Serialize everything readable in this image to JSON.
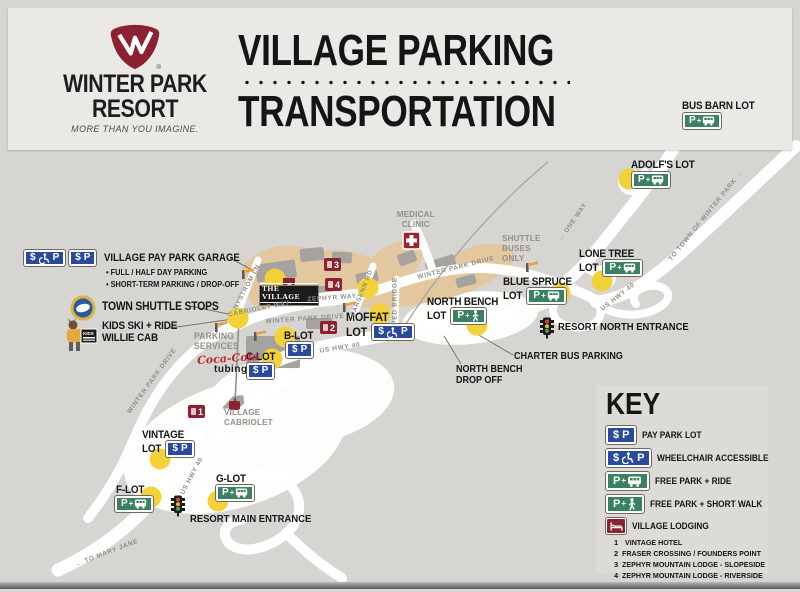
{
  "header": {
    "brand_top": "WINTER PARK",
    "brand_bottom": "RESORT",
    "reg": "®",
    "tagline": "MORE THAN YOU IMAGINE.",
    "title1": "VILLAGE PARKING",
    "title2": "TRANSPORTATION"
  },
  "glyphs": {
    "dollar": "$",
    "p": "P",
    "plus": "+",
    "bullet": "•"
  },
  "legend": {
    "garage_title": "VILLAGE PAY PARK GARAGE",
    "garage_b1": "FULL / HALF DAY PARKING",
    "garage_b2": "SHORT-TERM PARKING / DROP-OFF",
    "shuttle": "TOWN SHUTTLE STOPS",
    "kids1": "KIDS SKI + RIDE",
    "kids2": "WILLIE CAB"
  },
  "lots": {
    "bus_barn": "BUS BARN LOT",
    "adolfs": "ADOLF'S LOT",
    "lone_tree1": "LONE TREE",
    "blue_spruce1": "BLUE SPRUCE",
    "north_bench1": "NORTH BENCH",
    "moffat1": "MOFFAT",
    "lot_word": "LOT",
    "b": "B-LOT",
    "c": "C-LOT",
    "vintage1": "VINTAGE",
    "f": "F-LOT",
    "g": "G-LOT"
  },
  "pois": {
    "medical1": "MEDICAL",
    "medical2": "CLINIC",
    "sb1": "SHUTTLE",
    "sb2": "BUSES",
    "sb3": "ONLY",
    "resort_north": "RESORT NORTH ENTRANCE",
    "resort_main": "RESORT MAIN ENTRANCE",
    "charter": "CHARTER BUS PARKING",
    "drop1": "NORTH BENCH",
    "drop2": "DROP OFF",
    "parking1": "PARKING",
    "parking2": "SERVICES",
    "cab1": "VILLAGE",
    "cab2": "CABRIOLET",
    "village_banner": "THE VILLAGE",
    "village_sub": "AT WINTER PARK",
    "coke": "Coca-Cola",
    "tubing": "tubing"
  },
  "roads": {
    "nystrom": "NYSTROM LN",
    "cabriolet_way": "CABRIOLET WAY",
    "zephyr": "ZEPHYR WAY",
    "parsenn": "PARSENN RD",
    "ped": "PED BRIDGE",
    "wpd": "WINTER PARK DRIVE",
    "hwy": "US HWY 40",
    "one_way": "ONE WAY",
    "to_town": "TO TOWN OF WINTER PARK",
    "to_mary": "TO MARY JANE",
    "arr_l": "←",
    "arr_r": "→"
  },
  "key": {
    "title": "KEY",
    "pay": "PAY PARK LOT",
    "wc": "WHEELCHAIR ACCESSIBLE",
    "ride": "FREE PARK + RIDE",
    "walk": "FREE PARK + SHORT WALK",
    "lodging": "VILLAGE LODGING",
    "l1n": "1",
    "l1": "VINTAGE HOTEL",
    "l2n": "2",
    "l2": "FRASER CROSSING / FOUNDERS POINT",
    "l3n": "3",
    "l3": "ZEPHYR MOUNTAIN LODGE - SLOPESIDE",
    "l4n": "4",
    "l4": "ZEPHYR MOUNTAIN LODGE - RIVERSIDE",
    "l5": "CENTRAL LODGING CHECK-IN"
  },
  "markers": {
    "m1": "1",
    "m2": "2",
    "m3": "3",
    "m4": "4"
  },
  "colors": {
    "pay_blue": "#2a4a9c",
    "free_green": "#39815f",
    "brand_maroon": "#8c2132",
    "shuttle_yellow": "#f3d139",
    "village_beige": "#e3c79f"
  }
}
